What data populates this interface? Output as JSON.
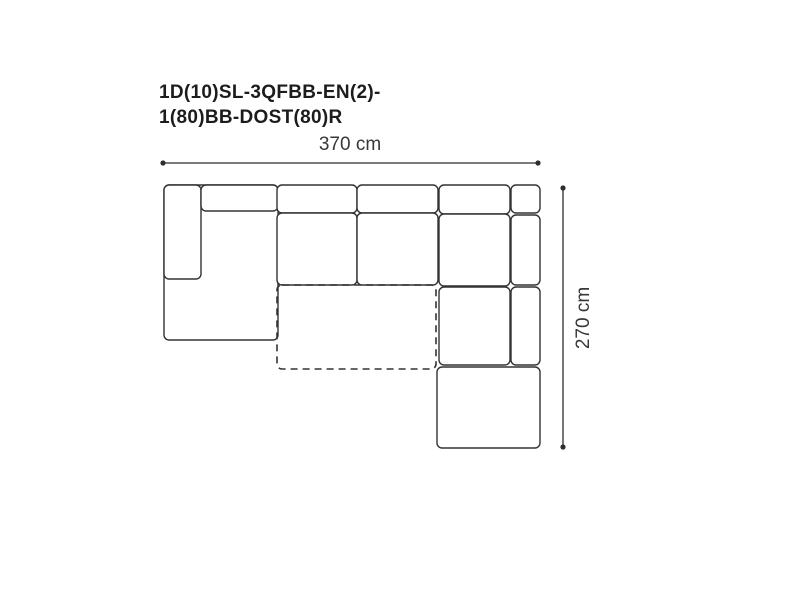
{
  "title": {
    "line1": "1D(10)SL-3QFBB-EN(2)-",
    "line2": "1(80)BB-DOST(80)R"
  },
  "dimensions": {
    "width_label": "370 cm",
    "height_label": "270 cm"
  },
  "colors": {
    "background": "#ffffff",
    "outline": "#333333",
    "dimension": "#2e2e2e",
    "title_text": "#1c1c1c",
    "label_text": "#383838"
  },
  "diagram": {
    "corner_radius": 5,
    "dash_pattern": "7 5",
    "pieces": [
      {
        "name": "left-chaise-body",
        "x": 164,
        "y": 185,
        "w": 114,
        "h": 155
      },
      {
        "name": "left-armrest",
        "x": 164,
        "y": 185,
        "w": 37,
        "h": 94
      },
      {
        "name": "left-backrest",
        "x": 201,
        "y": 185,
        "w": 77,
        "h": 26
      },
      {
        "name": "middle-backrest-1",
        "x": 277,
        "y": 185,
        "w": 80,
        "h": 28
      },
      {
        "name": "middle-backrest-2",
        "x": 357,
        "y": 185,
        "w": 81,
        "h": 28
      },
      {
        "name": "middle-seat-1",
        "x": 277,
        "y": 213,
        "w": 80,
        "h": 72
      },
      {
        "name": "middle-seat-2",
        "x": 357,
        "y": 213,
        "w": 81,
        "h": 72
      },
      {
        "name": "right-backrest",
        "x": 439,
        "y": 185,
        "w": 71,
        "h": 29
      },
      {
        "name": "right-corner-piece",
        "x": 511,
        "y": 185,
        "w": 29,
        "h": 28
      },
      {
        "name": "right-arm-strip-upper",
        "x": 511,
        "y": 215,
        "w": 29,
        "h": 70
      },
      {
        "name": "right-seat",
        "x": 439,
        "y": 214,
        "w": 71,
        "h": 72
      },
      {
        "name": "right-chaise-seat",
        "x": 439,
        "y": 287,
        "w": 71,
        "h": 78
      },
      {
        "name": "right-arm-strip-lower",
        "x": 511,
        "y": 287,
        "w": 29,
        "h": 78
      },
      {
        "name": "ottoman",
        "x": 437,
        "y": 367,
        "w": 103,
        "h": 81
      },
      {
        "name": "foldout-bed-outline",
        "x": 277,
        "y": 285,
        "w": 159,
        "h": 84,
        "dashed": true
      }
    ],
    "dimension_lines": [
      {
        "name": "width-dimension-line",
        "x1": 163,
        "y1": 163,
        "x2": 538,
        "y2": 163
      },
      {
        "name": "height-dimension-line",
        "x1": 563,
        "y1": 188,
        "x2": 563,
        "y2": 447
      }
    ]
  }
}
